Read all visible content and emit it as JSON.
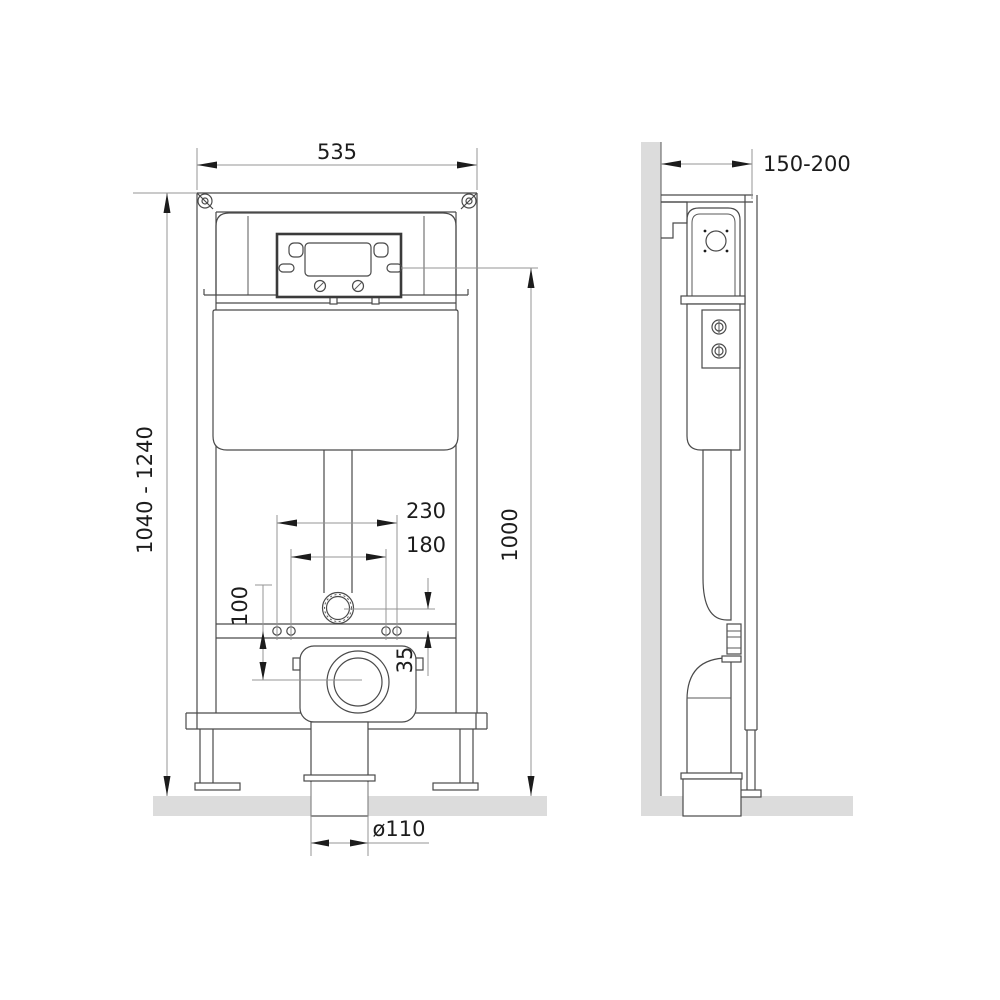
{
  "drawing": {
    "type": "technical-installation-drawing",
    "subject": "concealed wc cistern mounting frame, front and side elevation",
    "dimensions": {
      "frame_width": "535",
      "install_height_range": "1040 - 1240",
      "reference_height": "1000",
      "fixing_holes_outer_spacing": "230",
      "fixing_holes_inner_spacing": "180",
      "drain_center_offset": "100",
      "inlet_to_bar_offset": "35",
      "drain_pipe_diameter": "ø110",
      "frame_depth_range": "150-200"
    },
    "colors": {
      "outline": "#4a4a4a",
      "dimension_line": "#949494",
      "text": "#1c1c1c",
      "wall_floor_fill": "#dcdcdc"
    }
  }
}
